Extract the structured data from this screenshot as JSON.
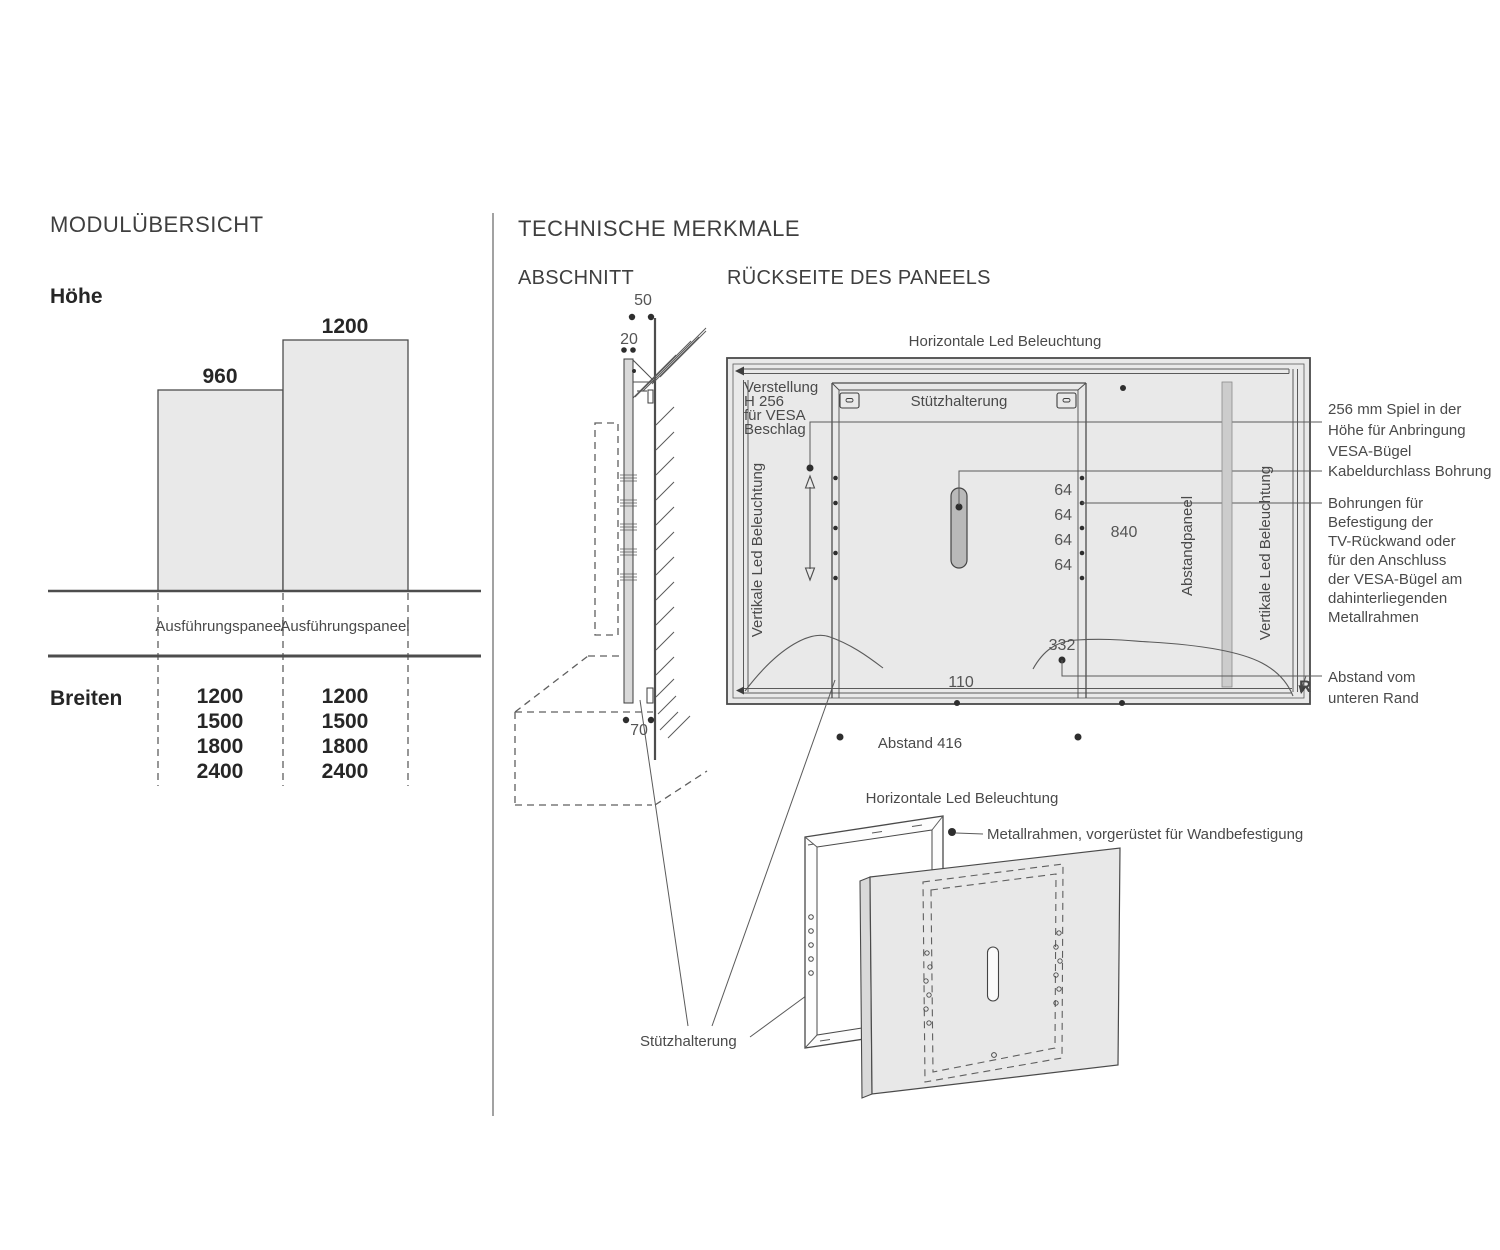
{
  "module_overview": {
    "title": "MODULÜBERSICHT",
    "height_label": "Höhe",
    "bars": [
      {
        "value": "960"
      },
      {
        "value": "1200"
      }
    ],
    "column_headers": [
      "Ausführungspaneel",
      "Ausführungspaneel"
    ],
    "widths_label": "Breiten",
    "width_columns": [
      [
        "1200",
        "1500",
        "1800",
        "2400"
      ],
      [
        "1200",
        "1500",
        "1800",
        "2400"
      ]
    ]
  },
  "technical": {
    "title": "TECHNISCHE MERKMALE",
    "section_heading": "ABSCHNITT",
    "back_heading": "RÜCKSEITE DES PANEELS"
  },
  "section_view": {
    "dim_top": "50",
    "dim_panel": "20",
    "dim_bottom": "70"
  },
  "back_view": {
    "top_led_label": "Horizontale Led Beleuchtung",
    "left_led_label": "Vertikale Led Beleuchtung",
    "right_led_label": "Vertikale Led Beleuchtung",
    "bracket_label": "Stützhalterung",
    "vesa_lines": [
      "Verstellung",
      "H 256",
      "für VESA",
      "Beschlag"
    ],
    "spacer_label": "Abstandpaneel",
    "hole_spacing": [
      "64",
      "64",
      "64",
      "64"
    ],
    "dim_height": "840",
    "dim_332": "332",
    "dim_110": "110",
    "corner_mark": "R",
    "bottom_spacing": "Abstand 416"
  },
  "callouts": {
    "vesa_play": [
      "256 mm Spiel in der",
      "Höhe für Anbringung",
      "VESA-Bügel"
    ],
    "cable": "Kabeldurchlass Bohrung",
    "holes": [
      "Bohrungen für",
      "Befestigung der",
      "TV-Rückwand oder",
      "für den Anschluss",
      "der VESA-Bügel am",
      "dahinterliegenden",
      "Metallrahmen"
    ],
    "bottom_edge": [
      "Abstand vom",
      "unteren Rand"
    ]
  },
  "exploded_view": {
    "top_label": "Horizontale Led Beleuchtung",
    "frame_label": "Metallrahmen, vorgerüstet für Wandbefestigung",
    "bracket_label": "Stützhalterung"
  },
  "colors": {
    "panel_fill": "#e9e9e9",
    "capsule_fill": "#b9b9b9",
    "line": "#4d4d4d"
  }
}
